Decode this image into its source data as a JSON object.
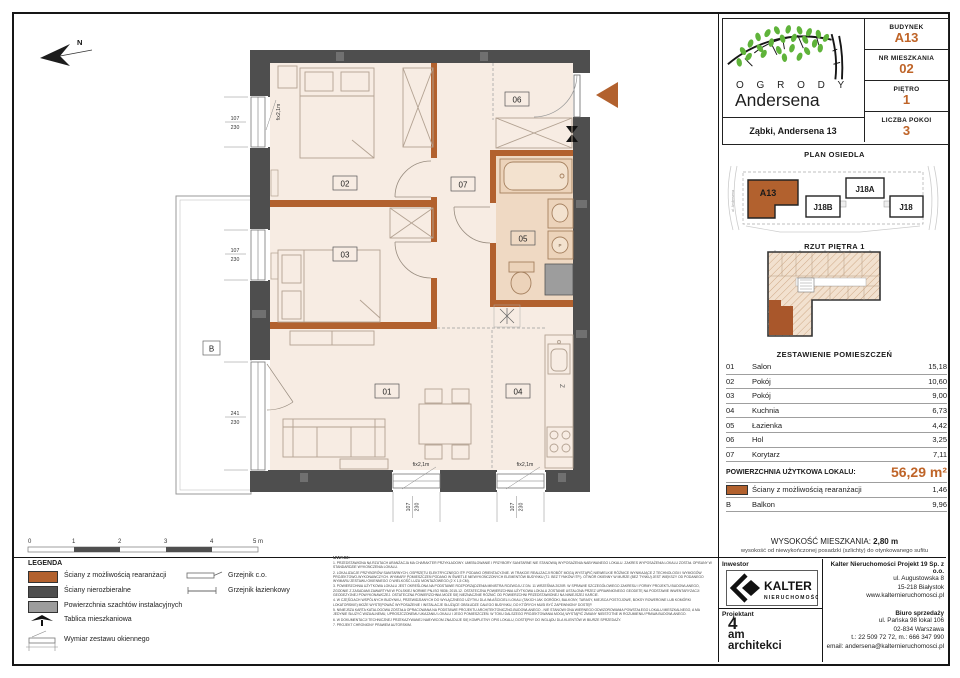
{
  "header": {
    "project_name_top": "O G R O D Y",
    "project_name_main": "Andersena",
    "address": "Ząbki, Andersena 13",
    "info": [
      {
        "label": "BUDYNEK",
        "value": "A13"
      },
      {
        "label": "NR MIESZKANIA",
        "value": "02"
      },
      {
        "label": "PIĘTRO",
        "value": "1"
      },
      {
        "label": "LICZBA POKOI",
        "value": "3"
      }
    ]
  },
  "site_plan": {
    "title": "PLAN OSIEDLA",
    "buildings": {
      "a13": "A13",
      "j18b": "J18B",
      "j18a": "J18A",
      "j18": "J18"
    },
    "street_left": "ul. Andersena"
  },
  "floor_overview": {
    "title": "RZUT PIĘTRA 1"
  },
  "rooms_table": {
    "title": "ZESTAWIENIE POMIESZCZEŃ",
    "rows": [
      {
        "no": "01",
        "name": "Salon",
        "area": "15,18"
      },
      {
        "no": "02",
        "name": "Pokój",
        "area": "10,60"
      },
      {
        "no": "03",
        "name": "Pokój",
        "area": "9,00"
      },
      {
        "no": "04",
        "name": "Kuchnia",
        "area": "6,73"
      },
      {
        "no": "05",
        "name": "Łazienka",
        "area": "4,42"
      },
      {
        "no": "06",
        "name": "Hol",
        "area": "3,25"
      },
      {
        "no": "07",
        "name": "Korytarz",
        "area": "7,11"
      }
    ],
    "total_label": "POWIERZCHNIA UŻYTKOWA LOKALU:",
    "total_value": "56,29 m²",
    "extra_rows": [
      {
        "no": "",
        "name": "Ściany z możliwością rearanżacji",
        "area": "1,46"
      },
      {
        "no": "B",
        "name": "Balkon",
        "area": "9,96"
      }
    ]
  },
  "height_info": {
    "label": "WYSOKOŚĆ MIESZKANIA:",
    "value": "2,80 m",
    "note": "wysokość od niewykończonej posadzki (szlichty) do otynkowanego sufitu"
  },
  "companies": {
    "investor_label": "Inwestor",
    "investor_logo_main": "KALTER",
    "investor_logo_sub": "nieruchomości",
    "investor_company": "Kalter Nieruchomości Projekt 19 Sp. z o.o.",
    "investor_address": [
      "ul. Augustowska 8",
      "15-218 Białystok",
      "www.kalternieruchomosci.pl"
    ],
    "designer_label": "Projektant",
    "designer_line1": "4",
    "designer_line2": "am",
    "designer_line3": "architekci",
    "sales_label": "Biuro sprzedaży",
    "sales_address": [
      "ul. Pańska 98 lokal 106",
      "02-834 Warszawa",
      "t.: 22 509 72 72, m.: 666 347 990",
      "email: andersena@kalternieruchomosci.pl"
    ]
  },
  "legend": {
    "title": "LEGENDA",
    "items_left": [
      "Ściany z możliwością rearanżacji",
      "Ściany nierozbieralne",
      "Powierzchnia szachtów instalacyjnych",
      "Tablica mieszkaniowa",
      "Wymiar zestawu okiennego"
    ],
    "items_right": [
      "Grzejnik c.o.",
      "Grzejnik łazienkowy"
    ]
  },
  "scale_bar": {
    "labels": [
      "0",
      "1",
      "2",
      "3",
      "4",
      "5 m"
    ]
  },
  "notes": {
    "title": "UWAGI:",
    "items": [
      "1. PRZEDSTAWIONA NA RZUTACH ARANŻACJA MA CHARAKTER PRZYKŁADOWY. UMEBLOWANIE I PRZYBORY SANITARNE NIE STANOWIĄ WYPOSAŻENIA NABYWANEGO LOKALU. ZAKRES WYPOSAŻENIA LOKALU ZOSTAŁ OPISANY W STANDARDZIE WYKOŃCZENIA LOKALU.",
      "2. LOKALIZACJE PRZYBORÓW SANITARNYCH, OSPRZĘTU ELEKTRYCZNEGO ITP. PODANO ORIENTACYJNIE. W TRAKCIE REALIZACJI ROBÓT MOGĄ WYSTĄPIĆ NIEWIELKIE RÓŻNICE WYNIKAJĄCE Z TECHNOLOGII I WYMOGÓW PROJEKTOWO-WYKONAWCZYCH. WYMIARY POMIESZCZEŃ PODANO W ŚWIETLE NIEWYKOŃCZONYCH ELEMENTÓW BUDYNKU (TJ. BEZ TYNKÓW ITP.). OTWÓR OKIENNY W MURZE (BEZ TYNKU) JEST WIĘKSZY OD PODANEGO WYMIARU ZESTAWU OKIENNEGO O WIELKOŚĆ LUZU MONTAŻOWEGO (2 X 1,5 CM).",
      "3. POWIERZCHNIA UŻYTKOWA LOKALU JEST OKREŚLONA NA PODSTAWIE ROZPORZĄDZENIA MINISTRA ROZWOJU Z DN. 11 WRZEŚNIA 2020R. W SPRAWIE SZCZEGÓŁOWEGO ZAKRESU I FORMY PROJEKTU BUDOWLANEGO, ZGODNIE Z ZASADAMI ZAWARTYMI W POLSKIEJ NORMIE PN-ISO 9836: 2015-12. OSTATECZNA POWIERZCHNIA UŻYTKOWA LOKALU ZOSTANIE USTALONA PRZEZ UPRAWNIONEGO GEODETĘ NA PODSTAWIE INWENTARYZACJI GEODEZYJNEJ POWYKONAWCZEJ. OSTATECZNA POWIERZCHNIA MOŻE SIĘ NIEZNACZNIE RÓŻNIĆ OD POWIERZCHNI PRZEDSTAWIONEJ NA NINIEJSZEJ KARCIE.",
      "4. W CZĘŚCIACH WSPÓLNYCH BUDYNKU, PRZEWIDZIANYCH DO WYŁĄCZNEGO UŻYTKU DLA WŁAŚCICIELI LOKALI (TAKICH JAK OGRÓDKI, BALKONY, TARASY, MIEJSCA POSTOJOWE, BOKSY ROWEROWE LUB KOMÓRKI LOKATORSKIE) MOŻE WYSTĘPOWAĆ WYPOSAŻENIE I INSTALACJE SŁUŻĄCE OBSŁUDZE CAŁEGO BUDYNKU, DO KTÓRYCH MUSI BYĆ ZAPEWNIONY DOSTĘP.",
      "5. NINIEJSZA KARTA KATALOGOWA ZOSTAŁA OPRACOWANA NA PODSTAWIE PROJEKTU ARCHITEKTONICZNO-BUDOWLANEGO - NIE STANOWI ONA WIERNEGO ODWZOROWANIA POWSTAŁEGO LOKALU MIESZKALNEGO, A MA JEDYNIE SŁUŻYĆ WIZUALNEMU, UPROSZCZONEMU UKAZANIU LOKALU I JEGO POMIESZCZEŃ. W TOKU DALSZEGO PROJEKTOWANIA MOGĄ WYSTĄPIĆ ZMIANY NIEISTOTNE W ROZUMIENIU PRAWA BUDOWLANEGO.",
      "6. W DOKUMENTACJI TECHNICZNEJ PRZEKAZYWANEJ NABYWCOM ZNAJDUJE SIĘ KOMPLETNY OPIS LOKALU, DOSTĘPNY DO WGLĄDU DLA KLIENTÓW W BIURZE SPRZEDAŻY.",
      "7. PROJEKT CHRONIONY PRAWEM AUTORSKIM."
    ]
  },
  "plan": {
    "room_labels": {
      "r01": "01",
      "r02": "02",
      "r03": "03",
      "r04": "04",
      "r05": "05",
      "r06": "06",
      "r07": "07",
      "balcony": "B"
    },
    "windows": {
      "w1a": "107",
      "w1b": "230",
      "w2a": "107",
      "w2b": "230",
      "w3a": "241",
      "w3b": "230",
      "w4a": "107",
      "w4b": "230",
      "w5a": "107",
      "w5b": "230"
    },
    "fix_labels": {
      "f1": "fix2,1m",
      "f2": "fix2,1m",
      "f3": "fix2,1m"
    },
    "north": "N",
    "kitchen_mark": "Z",
    "washer_mark": "P"
  },
  "colors": {
    "accent": "#bf6428",
    "wall_dark": "#4e4e4e",
    "wall_brown": "#b2612e",
    "shaft_gray": "#9d9d9d",
    "floor": "#f7ece3",
    "leaf_green": "#5fb33a"
  }
}
